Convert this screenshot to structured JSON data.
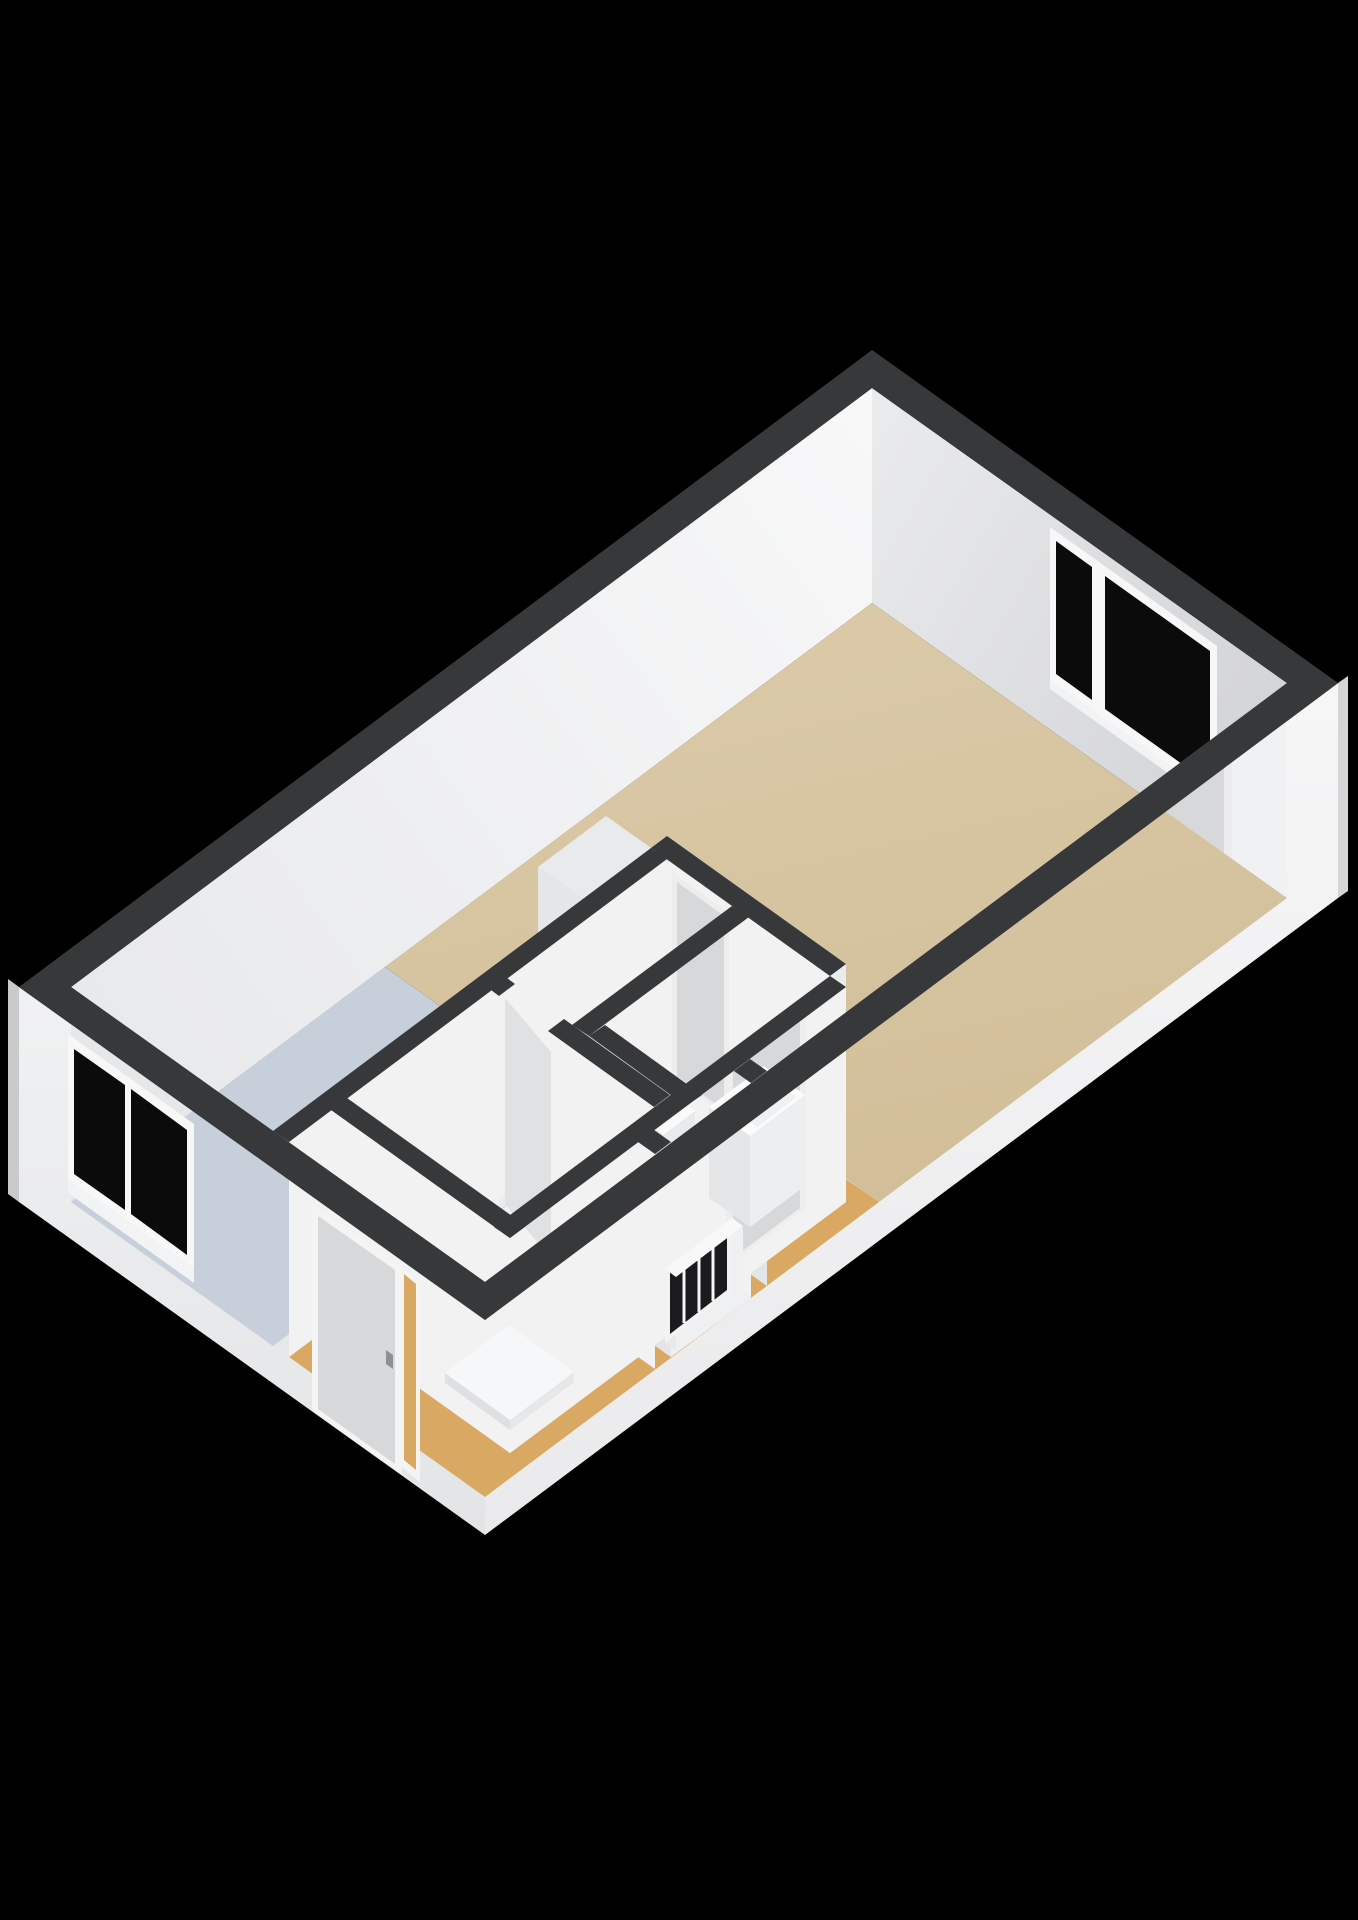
{
  "scene": {
    "kind": "isometric-3d-floorplan",
    "background": "#000000",
    "wall_height_px": 215
  },
  "colors": {
    "background": "#000000",
    "wall_top": "#37383a",
    "wall_interior": "#f2f2f3",
    "wall_interior_shade": "#e4e5e7",
    "wall_end": "#eaebed",
    "wall_a_inner_from": "#e9eaec",
    "wall_a_inner_to": "#d3d4d7",
    "wall_d_inner_from": "#f8f8f9",
    "wall_d_inner_to": "#e9eaec",
    "wall_c_inner": "#e6e7e9",
    "wall_b_inner": "#f0f1f2",
    "wall_b_outer_from": "#f6f6f7",
    "wall_b_outer_to": "#e9e9ea",
    "wall_c_outer_from": "#f0f1f2",
    "wall_c_outer_to": "#e2e3e4",
    "wall_sliver": "#c9cacc",
    "floor_living": "#d6c4a1",
    "floor_kitchen": "#c6cfda",
    "floor_wet": "#eff0f2",
    "floor_hall": "#d9a963",
    "glass": "#0b0b0c",
    "frame": "#f7f7f8",
    "door_leaf": "#d7d8da",
    "handle": "#8f9093",
    "fixture_top": "#fbfbfc",
    "fixture_side": "#eceef0",
    "fixture_side2": "#e4e6e8",
    "duct_top": "#e8eaec",
    "radiator_dark": "#1b1b1d"
  },
  "rooms": [
    {
      "id": "living-room",
      "floor": "beige",
      "floor_color": "#d6c4a1"
    },
    {
      "id": "kitchen",
      "floor": "light-blue",
      "floor_color": "#c6cfda"
    },
    {
      "id": "corridor",
      "floor": "white",
      "floor_color": "#eff0f2"
    },
    {
      "id": "toilet",
      "floor": "white",
      "floor_color": "#eff0f2"
    },
    {
      "id": "bathroom",
      "floor": "white",
      "floor_color": "#eff0f2"
    },
    {
      "id": "entrance-hall",
      "floor": "tan",
      "floor_color": "#d9a963"
    }
  ],
  "openings": {
    "windows": [
      {
        "id": "window-back-wall",
        "panes": 2
      },
      {
        "id": "window-kitchen-wall",
        "panes": 2
      }
    ],
    "doors": [
      {
        "id": "entrance-door",
        "wall": "front-left-exterior",
        "handle": true
      },
      {
        "id": "side-room-door",
        "wall": "right-exterior-inner",
        "handle": true
      },
      {
        "id": "corridor-door",
        "wall": "living-divider",
        "handle": false
      },
      {
        "id": "toilet-door",
        "wall": "toilet-right",
        "handle": true
      },
      {
        "id": "bathroom-door",
        "wall": "bathroom-top",
        "handle": false
      }
    ]
  },
  "fixtures": [
    "toilet",
    "hand-basin",
    "shower-tray",
    "radiator",
    "duct-column"
  ]
}
